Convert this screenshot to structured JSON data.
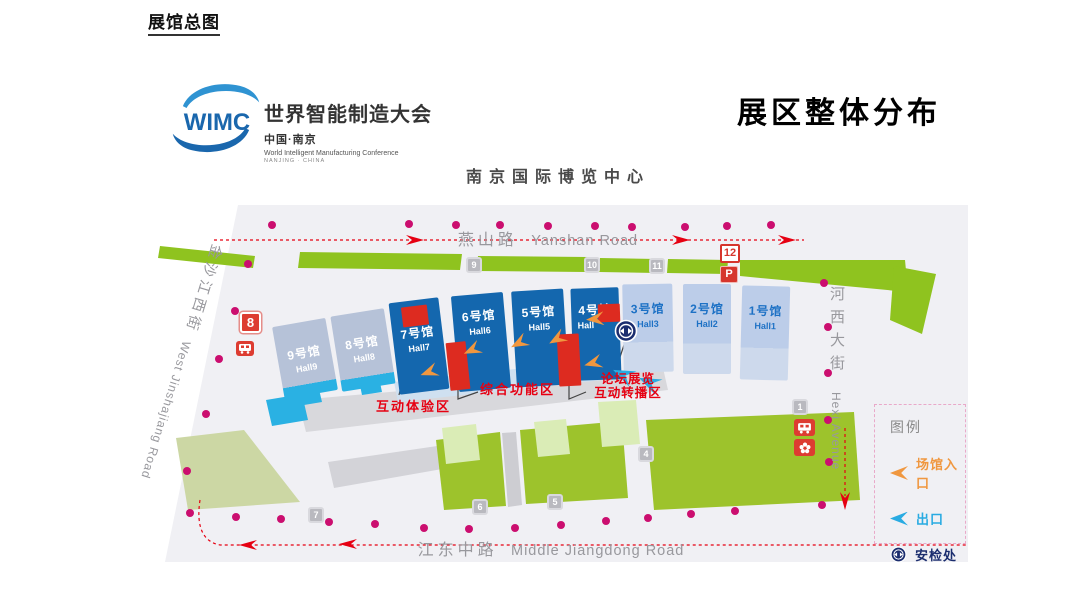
{
  "page": {
    "title": "展馆总图"
  },
  "brand": {
    "logo_acronym": "WIMC",
    "name_cn": "世界智能制造大会",
    "location_cn": "中国·南京",
    "name_en": "World Intelligent Manufacturing Conference",
    "location_en": "NANJING · CHINA"
  },
  "poster": {
    "title": "展区整体分布",
    "venue": "南京国际博览中心"
  },
  "map": {
    "roads": {
      "north_cn": "燕山路",
      "north_en": "Yanshan Road",
      "west_cn": "金沙江西街",
      "west_en": "West Jinshajiang Road",
      "east_cn": "河西大街",
      "east_en": "Hexi Avenue",
      "south_cn": "江东中路",
      "south_en": "Middle Jiangdong Road"
    },
    "halls": [
      {
        "cn": "9号馆",
        "en": "Hall9"
      },
      {
        "cn": "8号馆",
        "en": "Hall8"
      },
      {
        "cn": "7号馆",
        "en": "Hall7"
      },
      {
        "cn": "6号馆",
        "en": "Hall6"
      },
      {
        "cn": "5号馆",
        "en": "Hall5"
      },
      {
        "cn": "4号馆",
        "en": "Hall"
      },
      {
        "cn": "3号馆",
        "en": "Hall3"
      },
      {
        "cn": "2号馆",
        "en": "Hall2"
      },
      {
        "cn": "1号馆",
        "en": "Hall1"
      }
    ],
    "zones": {
      "interactive": "互动体验区",
      "function": "综合功能区",
      "forum_line1": "论坛展览",
      "forum_line2": "互动转播区"
    },
    "badges": {
      "b9": "9",
      "b10": "10",
      "b11": "11",
      "b12": "12",
      "parking": "P",
      "b8": "8",
      "b7": "7",
      "b6": "6",
      "b5": "5",
      "b4": "4",
      "b1": "1"
    },
    "legend": {
      "title": "图例",
      "entrance": "场馆入口",
      "exit": "出口",
      "security": "安检处"
    }
  },
  "icons": {
    "entrance": "entrance-arrow-icon",
    "exit": "exit-arrow-icon",
    "security": "security-check-icon",
    "bus": "bus-icon",
    "metro": "metro-icon",
    "parking": "parking-icon"
  },
  "colors": {
    "hall_dark": "#1467ae",
    "hall_light": "#b6c2d8",
    "hall_pale": "#bccde9",
    "green": "#8fc31f",
    "green_light": "#daecb6",
    "cyan": "#29abe2",
    "orange": "#f0973f",
    "red": "#e60012",
    "magenta": "#cb0e6f",
    "navy": "#1b2d6e",
    "badge_red": "#d6352c"
  }
}
